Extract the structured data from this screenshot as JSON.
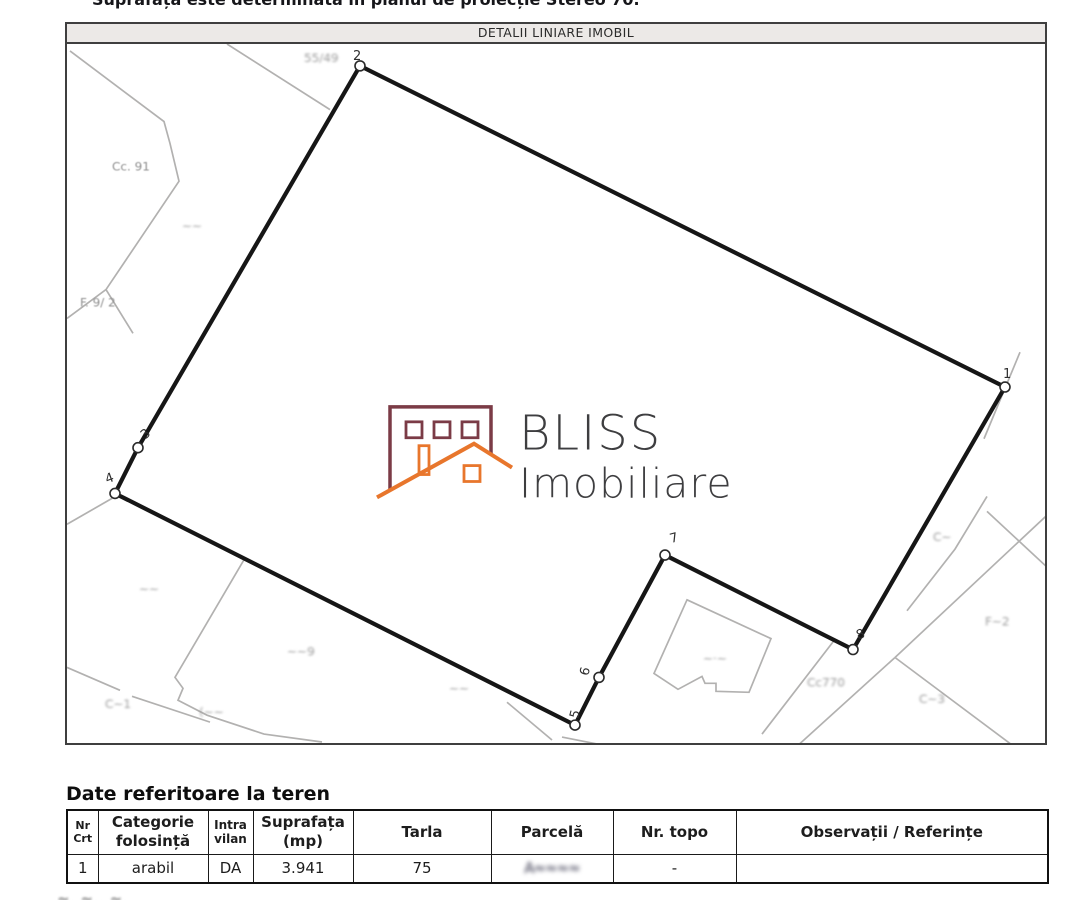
{
  "document": {
    "top_clipped_line": "Suprafața este determinată în planul de proiecție Stereo 70.",
    "section_title": "DETALII LINIARE IMOBIL",
    "bottom_clipped_fragment": "≈.  ≈..  ≈."
  },
  "map": {
    "vertex_labels": [
      "1",
      "2",
      "3",
      "4",
      "5",
      "6",
      "7",
      "8"
    ],
    "parcel_labels": {
      "near_vertex_2": "55/49",
      "upper_left": "Cc. 91",
      "upper_left_2": "~~",
      "left": "F. 9/ 2",
      "bottom_1": "~~",
      "bottom_2": "~~9",
      "bottom_3": "C~1",
      "bottom_4": "(~~",
      "bottom_5": "~~",
      "building": "~·~",
      "right_of_8": "Cc770",
      "right_1": "C~",
      "right_2": "F~2",
      "right_3": "C~3"
    },
    "watermark": {
      "line1": "BLISS",
      "line2": "Imobiliare",
      "building_color": "#7b3b46",
      "roof_color": "#e8762c",
      "text_color": "#3e3e40"
    }
  },
  "land_table": {
    "heading": "Date referitoare la teren",
    "columns": [
      [
        "Nr",
        "Crt"
      ],
      [
        "Categorie",
        "folosință"
      ],
      [
        "Intra",
        "vilan"
      ],
      [
        "Suprafața",
        "(mp)"
      ],
      [
        "Tarla"
      ],
      [
        "Parcelă"
      ],
      [
        "Nr. topo"
      ],
      [
        "Observații / Referințe"
      ]
    ],
    "row": {
      "nr_crt": "1",
      "categorie": "arabil",
      "intravilan": "DA",
      "suprafata": "3.941",
      "tarla": "75",
      "parcela": "A≈≈≈≈",
      "nr_topo": "-",
      "observatii": ""
    }
  }
}
